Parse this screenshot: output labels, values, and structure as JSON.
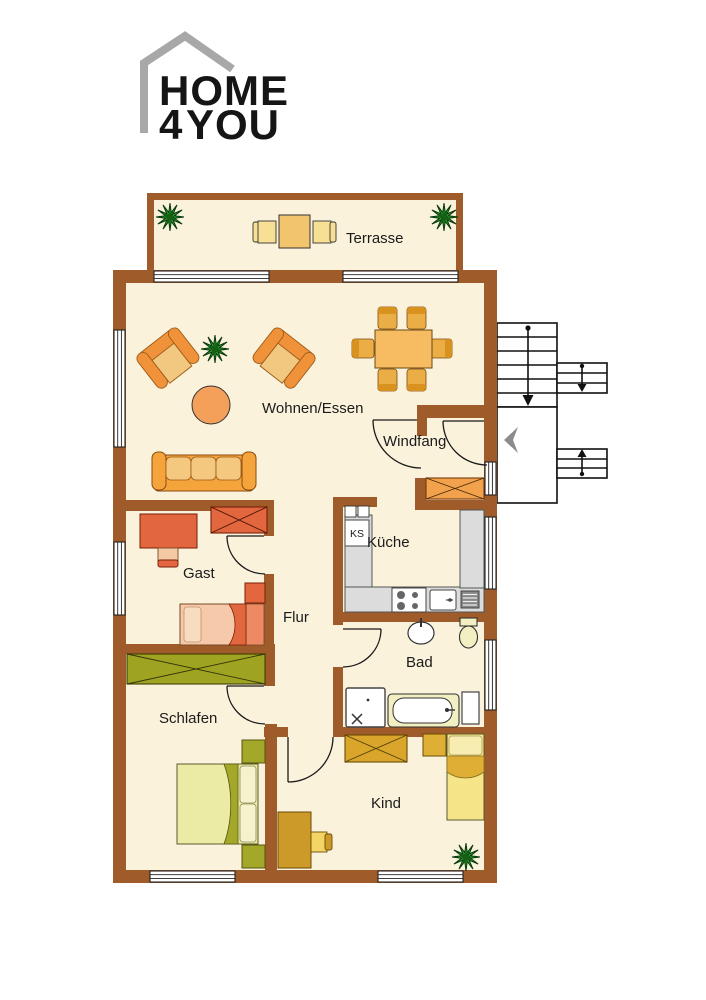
{
  "logo": {
    "word_top": "HOME",
    "accent_char": "4",
    "word_bottom": "YOU"
  },
  "room_labels": {
    "terrasse": "Terrasse",
    "wohnen_essen": "Wohnen/Essen",
    "windfang": "Windfang",
    "kueche": "Küche",
    "kuehlschrank_abbr": "KS",
    "gast": "Gast",
    "flur": "Flur",
    "bad": "Bad",
    "schlafen": "Schlafen",
    "kind": "Kind"
  },
  "colors": {
    "wall_brown": "#9F5B2A",
    "floor_cream": "#FAF2DB",
    "logo_accent_orange": "#F5A11C",
    "logo_house_gray": "#A8A8A8",
    "plant_green": "#2F9E2F",
    "living_furniture_orange": "#F0923A",
    "gast_furniture_red": "#E2673F",
    "schlafen_furniture_olive": "#9EA421",
    "kind_furniture_gold": "#D9A62B",
    "kitchen_counter_gray": "#DCDCDC",
    "bath_fixture_pale": "#F2F0C2",
    "entry_arrow_gray": "#8C8C8C"
  }
}
